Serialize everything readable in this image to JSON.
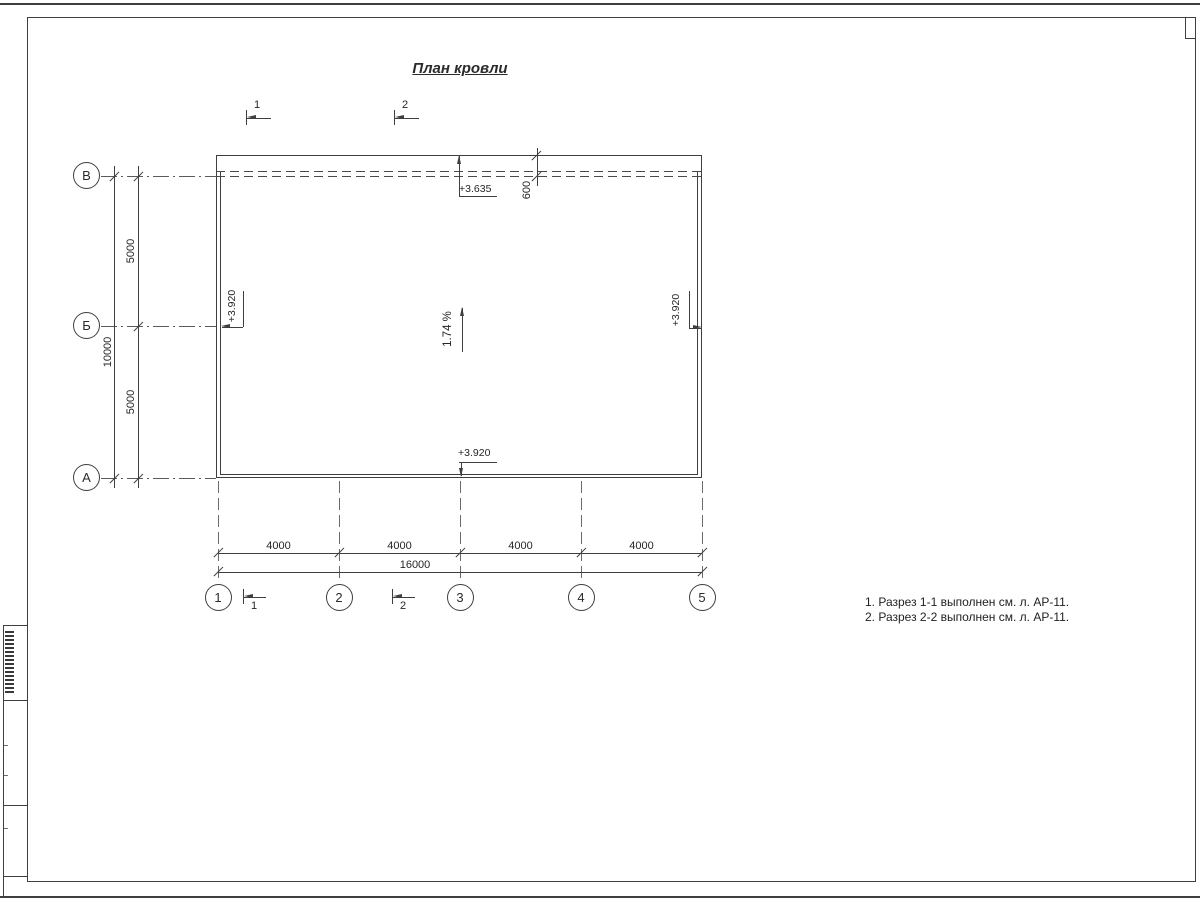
{
  "title": "План кровли",
  "axes": {
    "rows": [
      "В",
      "Б",
      "А"
    ],
    "cols": [
      "1",
      "2",
      "3",
      "4",
      "5"
    ]
  },
  "dims": {
    "v_bays": [
      "5000",
      "5000"
    ],
    "v_total": "10000",
    "h_bays": [
      "4000",
      "4000",
      "4000",
      "4000"
    ],
    "h_total": "16000",
    "parapet": "600"
  },
  "elev": {
    "top": "+3.635",
    "left": "+3.920",
    "right": "+3.920",
    "bottom": "+3.920"
  },
  "slope": "1.74 %",
  "sections": {
    "top1": "1",
    "top2": "2",
    "bottom1": "1",
    "bottom2": "2"
  },
  "notes": [
    "1. Разрез 1-1 выполнен см. л. АР-11.",
    "2. Разрез 2-2 выполнен см. л. АР-11."
  ],
  "colors": {
    "line": "#3f3f3f",
    "background": "#ffffff"
  }
}
